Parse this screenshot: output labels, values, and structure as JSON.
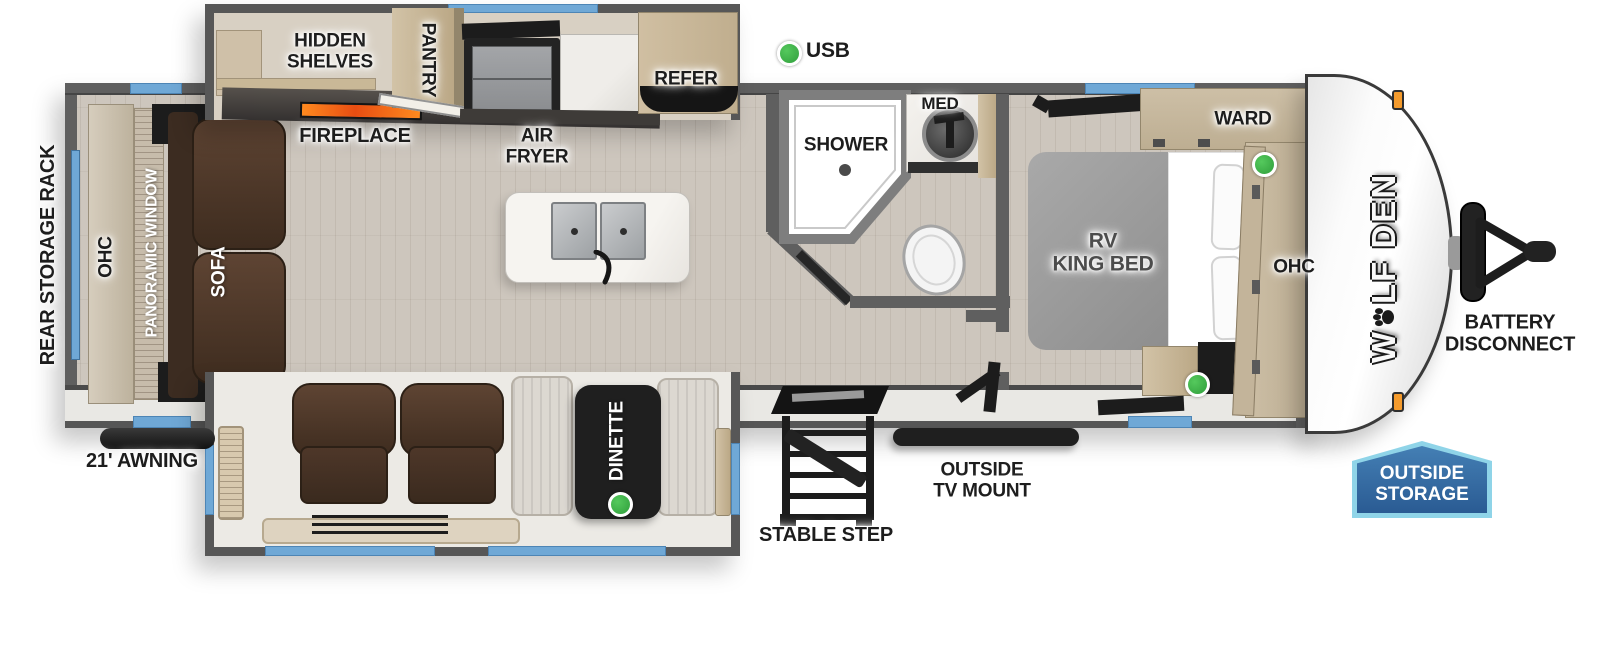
{
  "colors": {
    "window_blue": "#6fa8d6",
    "usb_green": "#3cb54a",
    "badge_blue": "#2e62a0",
    "badge_border": "#8fd4e8",
    "flame_orange": "#f2641c",
    "marker_orange": "#f59b2c"
  },
  "exterior": {
    "rear_storage_rack": "REAR STORAGE RACK",
    "awning": "21' AWNING",
    "stable_step": "STABLE STEP",
    "tv_mount_line1": "OUTSIDE",
    "tv_mount_line2": "TV MOUNT",
    "battery_line1": "BATTERY",
    "battery_line2": "DISCONNECT",
    "storage_line1": "OUTSIDE",
    "storage_line2": "STORAGE",
    "brand_prefix": "W",
    "brand_suffix": "LF DEN"
  },
  "living": {
    "sofa": "SOFA",
    "panoramic_window": "PANORAMIC WINDOW",
    "ohc": "OHC",
    "fireplace": "FIREPLACE",
    "hidden_line1": "HIDDEN",
    "hidden_line2": "SHELVES",
    "dinette": "DINETTE"
  },
  "kitchen": {
    "pantry": "PANTRY",
    "air_line1": "AIR",
    "air_line2": "FRYER",
    "refer": "REFER",
    "usb": "USB"
  },
  "bath": {
    "shower": "SHOWER",
    "med": "MED"
  },
  "bedroom": {
    "bed_line1": "RV",
    "bed_line2": "KING BED",
    "ward": "WARD",
    "ohc": "OHC"
  }
}
